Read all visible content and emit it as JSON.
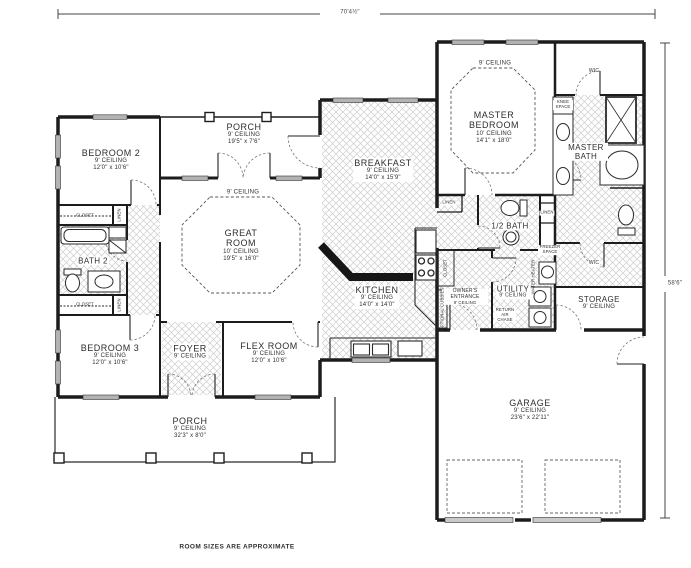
{
  "meta": {
    "plan_note": "ROOM SIZES ARE APPROXIMATE"
  },
  "dimensions": {
    "overall_width": "70'4½\"",
    "overall_depth": "58'6\""
  },
  "rooms": {
    "bedroom2": {
      "name": "BEDROOM 2",
      "ceiling": "9' CEILING",
      "size": "12'0\" x 10'6\""
    },
    "porch_top": {
      "name": "PORCH",
      "ceiling": "9' CEILING",
      "size": "19'5\" x 7'6\""
    },
    "great_room": {
      "name": "GREAT ROOM",
      "ceiling": "9' CEILING",
      "tray_ceiling": "10' CEILING",
      "size": "19'5\" x 16'0\""
    },
    "breakfast": {
      "name": "BREAKFAST",
      "ceiling": "9' CEILING",
      "size": "14'0\" x 15'9\""
    },
    "kitchen": {
      "name": "KITCHEN",
      "ceiling": "9' CEILING",
      "size": "14'0\" x 14'0\""
    },
    "master_bedroom": {
      "name": "MASTER BEDROOM",
      "ceiling": "9' CEILING",
      "tray_ceiling": "10' CEILING",
      "size": "14'1\" x 18'0\""
    },
    "master_bath": {
      "name": "MASTER BATH"
    },
    "half_bath": {
      "name": "1/2 BATH"
    },
    "bath2": {
      "name": "BATH 2"
    },
    "utility": {
      "name": "UTILITY",
      "ceiling": "9' CEILING"
    },
    "storage": {
      "name": "STORAGE",
      "ceiling": "9' CEILING"
    },
    "owners_entrance": {
      "name": "OWNER'S ENTRANCE",
      "ceiling": "9' CEILING"
    },
    "bedroom3": {
      "name": "BEDROOM 3",
      "ceiling": "9' CEILING",
      "size": "12'0\" x 10'6\""
    },
    "foyer": {
      "name": "FOYER",
      "ceiling": "9' CEILING"
    },
    "flex_room": {
      "name": "FLEX ROOM",
      "ceiling": "9' CEILING",
      "size": "12'0\" x 10'6\""
    },
    "porch_bottom": {
      "name": "PORCH",
      "ceiling": "9' CEILING",
      "size": "32'3\" x 8'0\""
    },
    "garage": {
      "name": "GARAGE",
      "ceiling": "9' CEILING",
      "size": "23'6\" x 22'11\""
    }
  },
  "fixtures": {
    "closet_bedroom2": "CLOSET",
    "closet_bedroom3": "CLOSET",
    "linen_hall_top": "LINEN",
    "linen_hall_bottom": "LINEN",
    "linen_master_hall": "LINEN",
    "linen_half_bath": "LINEN",
    "wic_master_top": "WIC",
    "wic_master_bottom": "WIC",
    "knee_space": "KNEE SPACE",
    "freezer_space": "FREEZER SPACE",
    "water_heater": "WATER HEATER",
    "optional_cubbies": "OPTIONAL CUBBIES",
    "pantry_closet": "CLOSET",
    "return_air": "RETURN AIR CHASE"
  }
}
